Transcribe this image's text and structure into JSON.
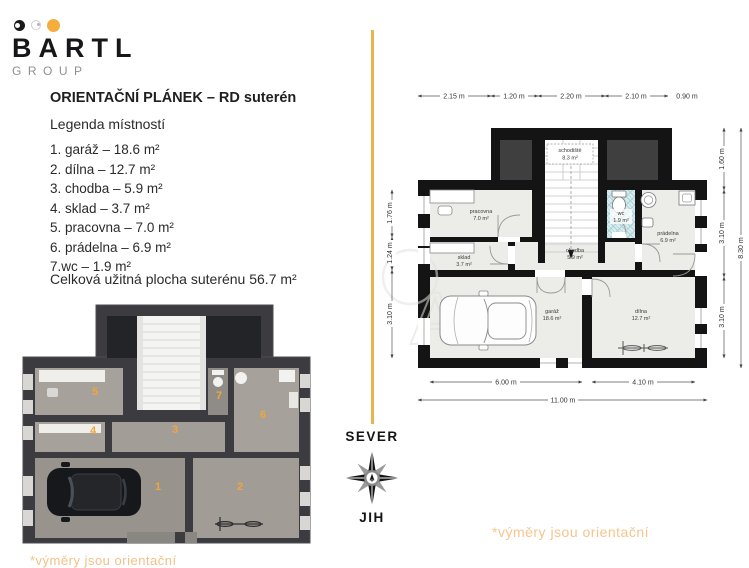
{
  "brand": {
    "name": "BARTL",
    "group": "GROUP"
  },
  "title": "ORIENTAČNÍ PLÁNEK – RD suterén",
  "legend": {
    "heading": "Legenda místností",
    "items": [
      {
        "text": "1. garáž – 18.6 m²"
      },
      {
        "text": "2. dílna – 12.7 m²"
      },
      {
        "text": "3. chodba – 5.9 m²"
      },
      {
        "text": "4. sklad – 3.7 m²"
      },
      {
        "text": "5. pracovna – 7.0 m²"
      },
      {
        "text": "6. prádelna – 6.9 m²"
      },
      {
        "text": "7.wc – 1.9 m²"
      }
    ],
    "total": "Celková užitná plocha suterénu 56.7 m²"
  },
  "compass": {
    "north": "SEVER",
    "south": "JIH"
  },
  "note": "*výměry jsou orientační",
  "plan2d": {
    "rooms": {
      "schodiste": {
        "name": "schodiště",
        "area": "8.3 m²"
      },
      "pracovna": {
        "name": "pracovna",
        "area": "7.0 m²"
      },
      "wc": {
        "name": "wc",
        "area": "1.9 m²"
      },
      "pradelna": {
        "name": "prádelna",
        "area": "6.9 m²"
      },
      "sklad": {
        "name": "sklad",
        "area": "3.7 m²"
      },
      "chodba": {
        "name": "chodba",
        "area": "5.9 m²"
      },
      "garaz": {
        "name": "garáž",
        "area": "18.6 m²"
      },
      "dilna": {
        "name": "dílna",
        "area": "12.7 m²"
      }
    },
    "dims_top": [
      "2.15 m",
      "1.20 m",
      "2.20 m",
      "2.10 m",
      "0.90 m"
    ],
    "dims_left": [
      "1.76 m",
      "1.24 m",
      "3.10 m"
    ],
    "dims_right": [
      "1.60 m",
      "3.10 m",
      "3.10 m"
    ],
    "dims_right_total": "8.30 m",
    "dims_bottom": [
      "6.00 m",
      "4.10 m"
    ],
    "dim_total_width": "11.00 m"
  },
  "plan3d": {
    "numbers": [
      "1",
      "2",
      "3",
      "4",
      "5",
      "6",
      "7"
    ]
  },
  "colors": {
    "accent": "#f3ae3d",
    "note": "#f6c58c",
    "wall2d": "#141414",
    "wall3d": "#3b3b40"
  }
}
